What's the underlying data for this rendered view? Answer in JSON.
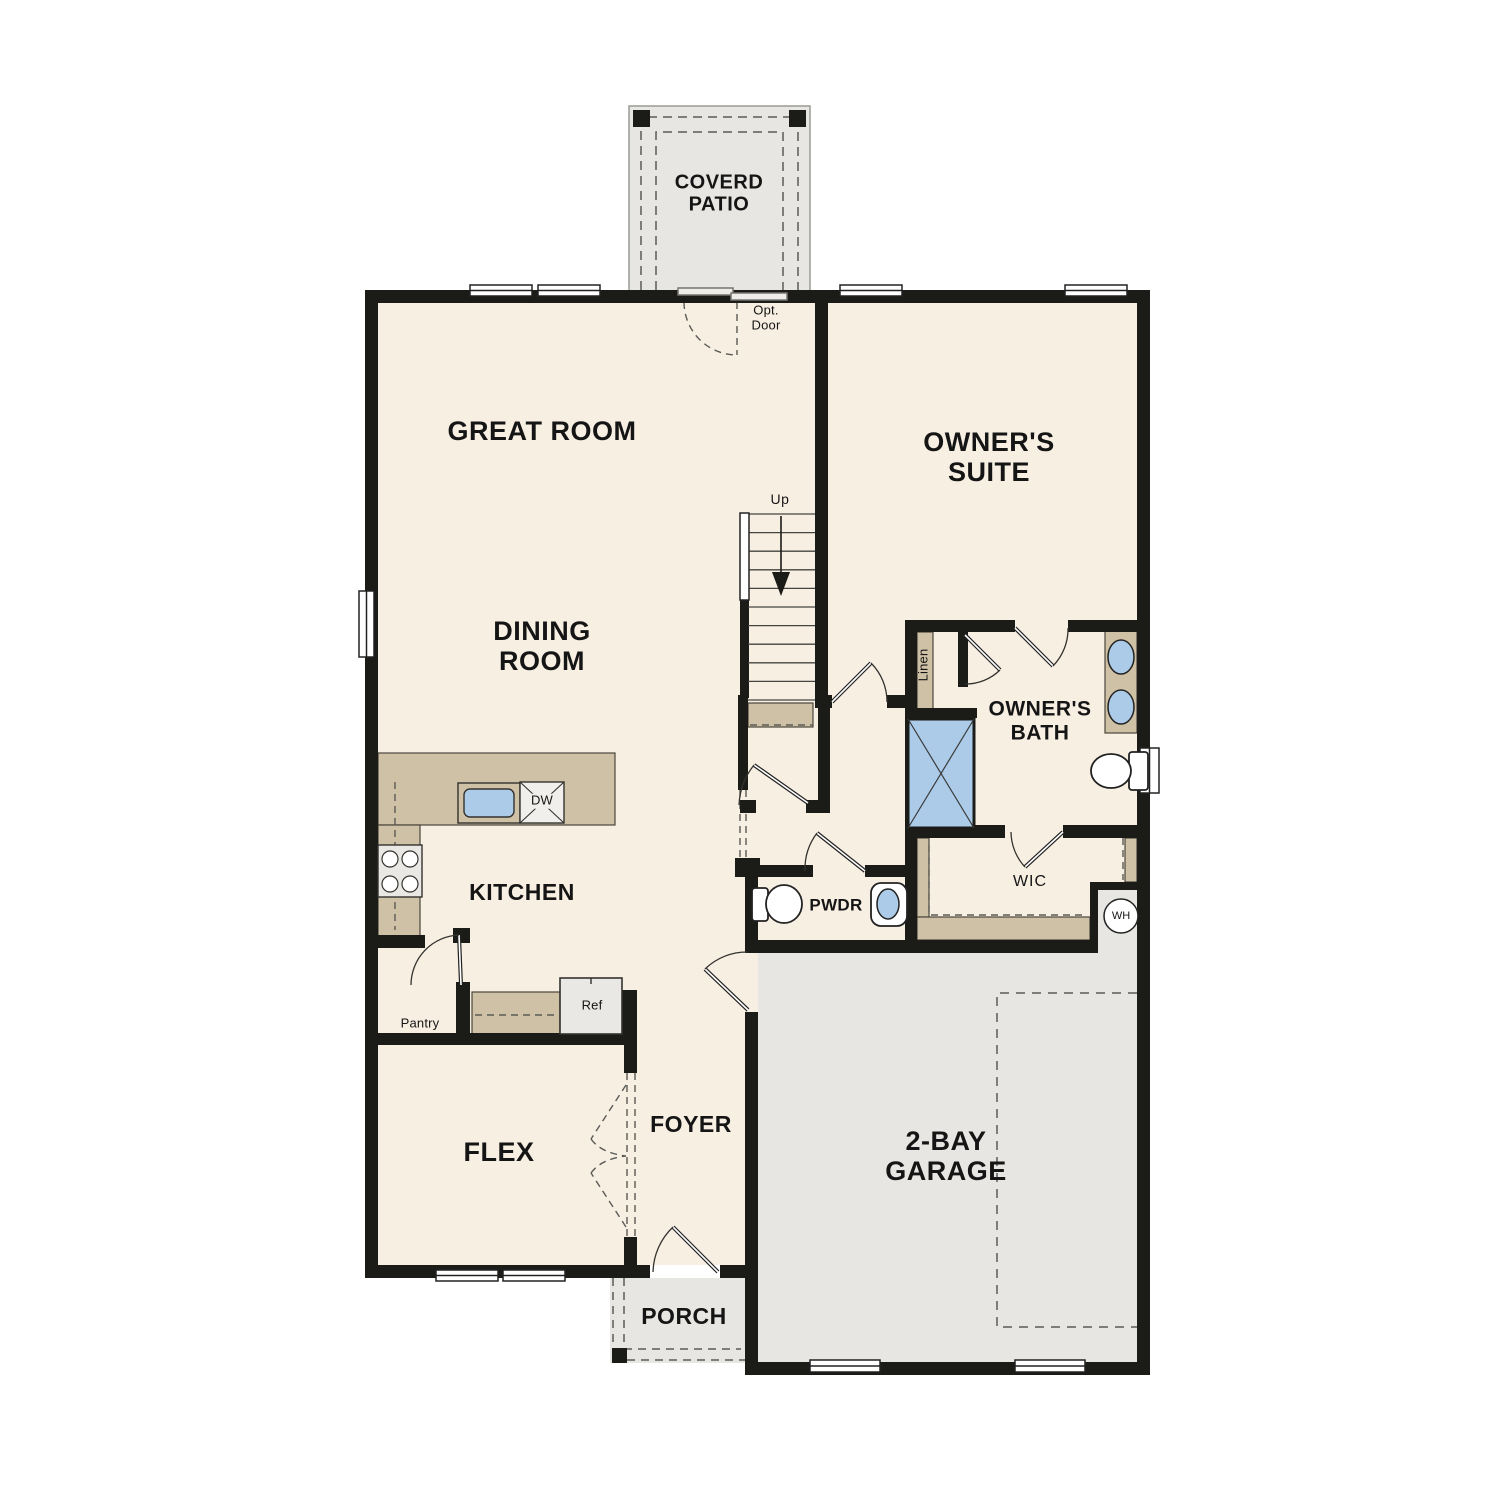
{
  "plan": {
    "covered_patio": "COVERD\nPATIO",
    "great_room": "GREAT ROOM",
    "owners_suite": "OWNER'S\nSUITE",
    "dining_room": "DINING\nROOM",
    "owners_bath": "OWNER'S\nBATH",
    "kitchen": "KITCHEN",
    "flex": "FLEX",
    "foyer": "FOYER",
    "garage": "2-BAY\nGARAGE",
    "porch": "PORCH",
    "pwdr": "PWDR",
    "wic": "WIC"
  },
  "annotations": {
    "opt_door": "Opt.\nDoor",
    "up": "Up",
    "linen": "Linen",
    "pantry": "Pantry",
    "ref": "Ref",
    "dw": "DW",
    "wh": "WH"
  },
  "colors": {
    "interior_floor": "#f8efe3",
    "hard_surface_floor": "#e7e6e2",
    "cabinetry": "#cfc1a5",
    "plumbing_fixture_blue": "#abcbe9",
    "wall_black": "#1b1b18"
  }
}
